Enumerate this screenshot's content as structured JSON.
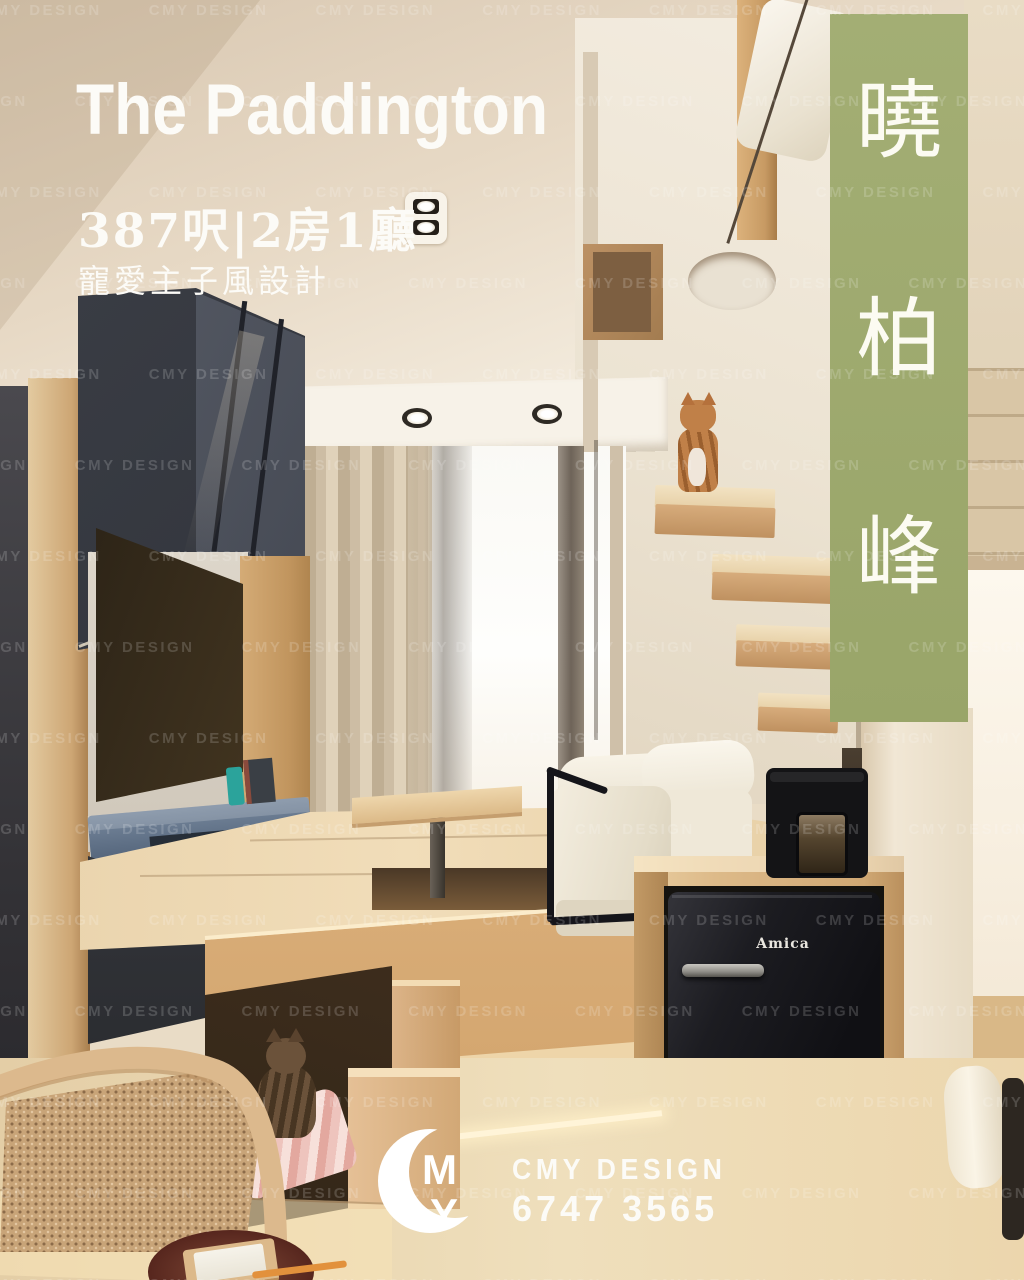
{
  "poster": {
    "title": "The Paddington",
    "subtitle": "387呎|2房1廳",
    "tagline": "寵愛主子風設計",
    "banner": {
      "characters": [
        "曉",
        "柏",
        "峰"
      ],
      "color": "#a0ac72"
    },
    "watermark": {
      "text": "CMY DESIGN"
    },
    "logo": {
      "monogram_top": "M",
      "monogram_bottom": "Y",
      "company": "CMY DESIGN",
      "phone": "6747 3565"
    }
  },
  "scene": {
    "fridge_brand": "Amica"
  },
  "colors": {
    "banner_green": "#a0ac72",
    "cabinet_navy": "#34373e",
    "media_shelf_blue": "#5f7288",
    "wood_light": "#d7b282",
    "sofa_cream": "#f2ecdd",
    "fridge_black": "#1c1c21"
  }
}
